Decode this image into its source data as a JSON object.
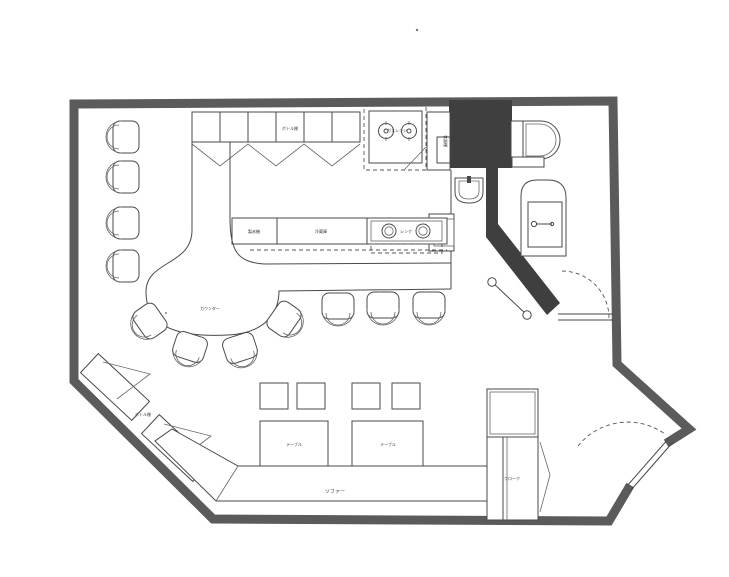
{
  "drawing": {
    "kind": "scanned floor plan (bar / restaurant)",
    "colors": {
      "paper": "#ffffff",
      "wall": "#5b5b5b",
      "line": "#4a4a4a",
      "shaft_fill": "#3f3f3f"
    }
  },
  "labels": {
    "bottle_shelf_top": "ボトル棚",
    "gas_range": "ガスレンジ",
    "tall_cupboard": "食器棚",
    "ice_machine": "製氷機",
    "refrigerator": "冷蔵庫",
    "sink": "シンク",
    "counter": "カウンター",
    "bottle_shelf_side": "ボトル棚",
    "table_1": "テーブル",
    "table_2": "テーブル",
    "sofa": "ソファー",
    "cloak": "クローク"
  }
}
